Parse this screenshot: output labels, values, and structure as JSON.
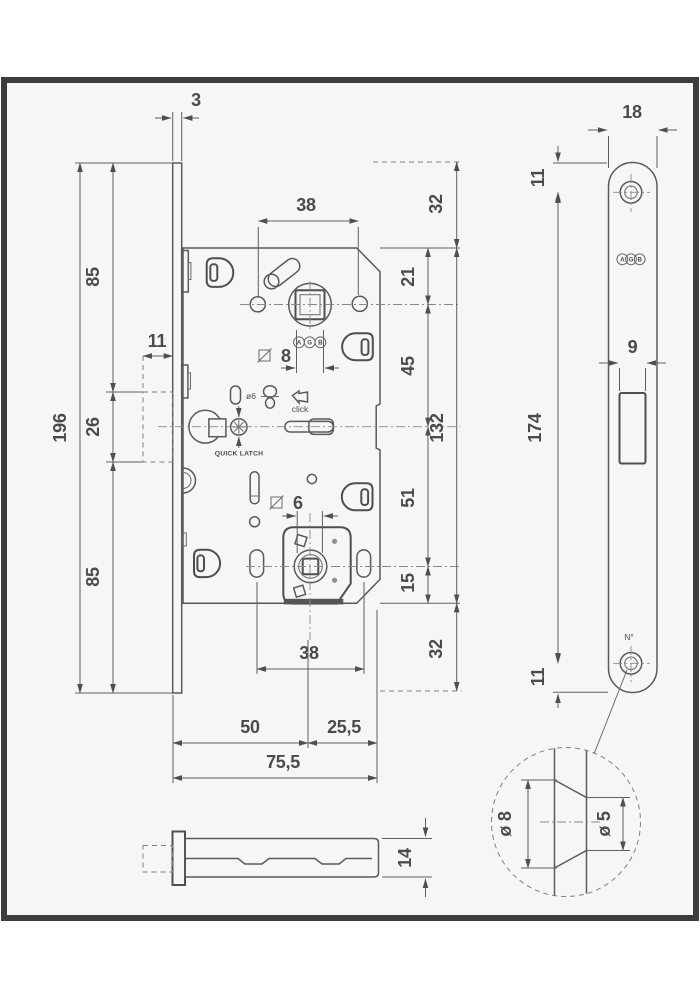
{
  "drawing_title": "AGB magnetic mortise lock technical drawing",
  "front_view": {
    "dims": {
      "plate_thickness": "3",
      "plate_length": "196",
      "upper_85": "85",
      "magnet_26": "26",
      "lower_85": "85",
      "latch_11": "11",
      "handle_span_38": "38",
      "top_32": "32",
      "follower_21": "21",
      "magnet_45": "45",
      "body_132": "132",
      "wc_51": "51",
      "bottom_15": "15",
      "bottom_32": "32",
      "screw_span_38": "38",
      "backset_50": "50",
      "rear_25_5": "25,5",
      "depth_75_5": "75,5",
      "spindle_square_8": "8",
      "wc_square_6": "6",
      "latch_pin_dia": "ø6"
    },
    "labels": {
      "click": "click",
      "quick_latch": "QUICK LATCH"
    },
    "logo": {
      "a": "A",
      "g": "G",
      "b": "B"
    }
  },
  "faceplate_view": {
    "dims": {
      "width_18": "18",
      "top_hole_11": "11",
      "magnet_slot_9": "9",
      "screw_spacing_174": "174",
      "bottom_hole_11": "11"
    },
    "labels": {
      "serial_mark": "N°"
    },
    "logo": {
      "a": "A",
      "g": "G",
      "b": "B"
    }
  },
  "section_view": {
    "dims": {
      "thickness_14": "14"
    }
  },
  "detail_view": {
    "dims": {
      "countersink_dia": "ø 8",
      "hole_dia": "ø 5"
    }
  }
}
